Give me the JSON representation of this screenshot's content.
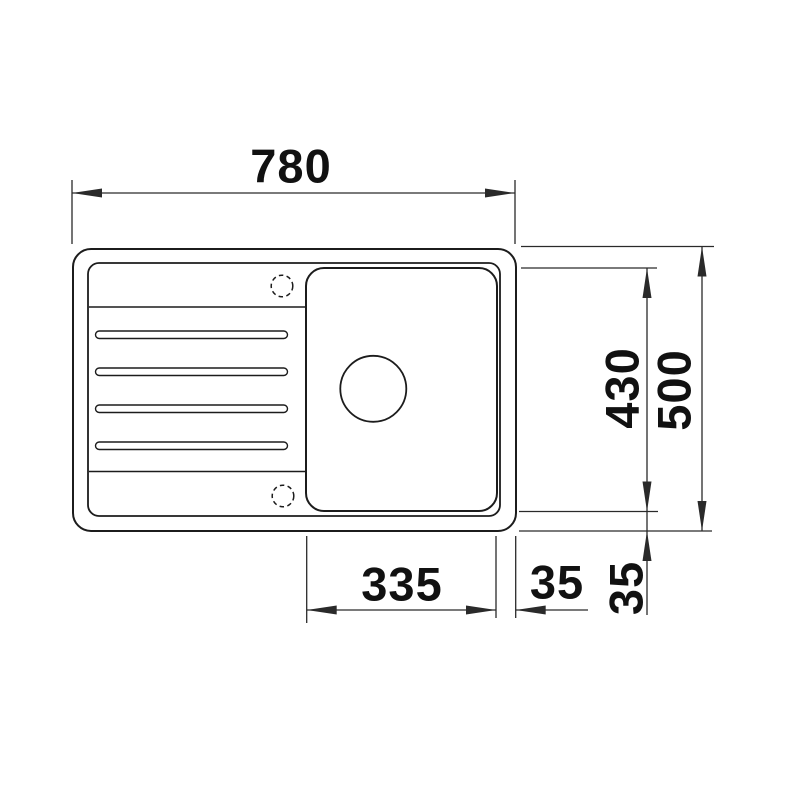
{
  "theme": {
    "background": "#ffffff",
    "drawing_line_color": "#1c1c1c",
    "dimension_line_color": "#2a2a2a",
    "label_text_color": "#111111"
  },
  "drawing": {
    "dimensions": {
      "overall_width": "780",
      "overall_depth": "500",
      "bowl_depth": "430",
      "bowl_width": "335",
      "bowl_right_offset": "35",
      "bowl_bottom_offset": "35"
    }
  }
}
